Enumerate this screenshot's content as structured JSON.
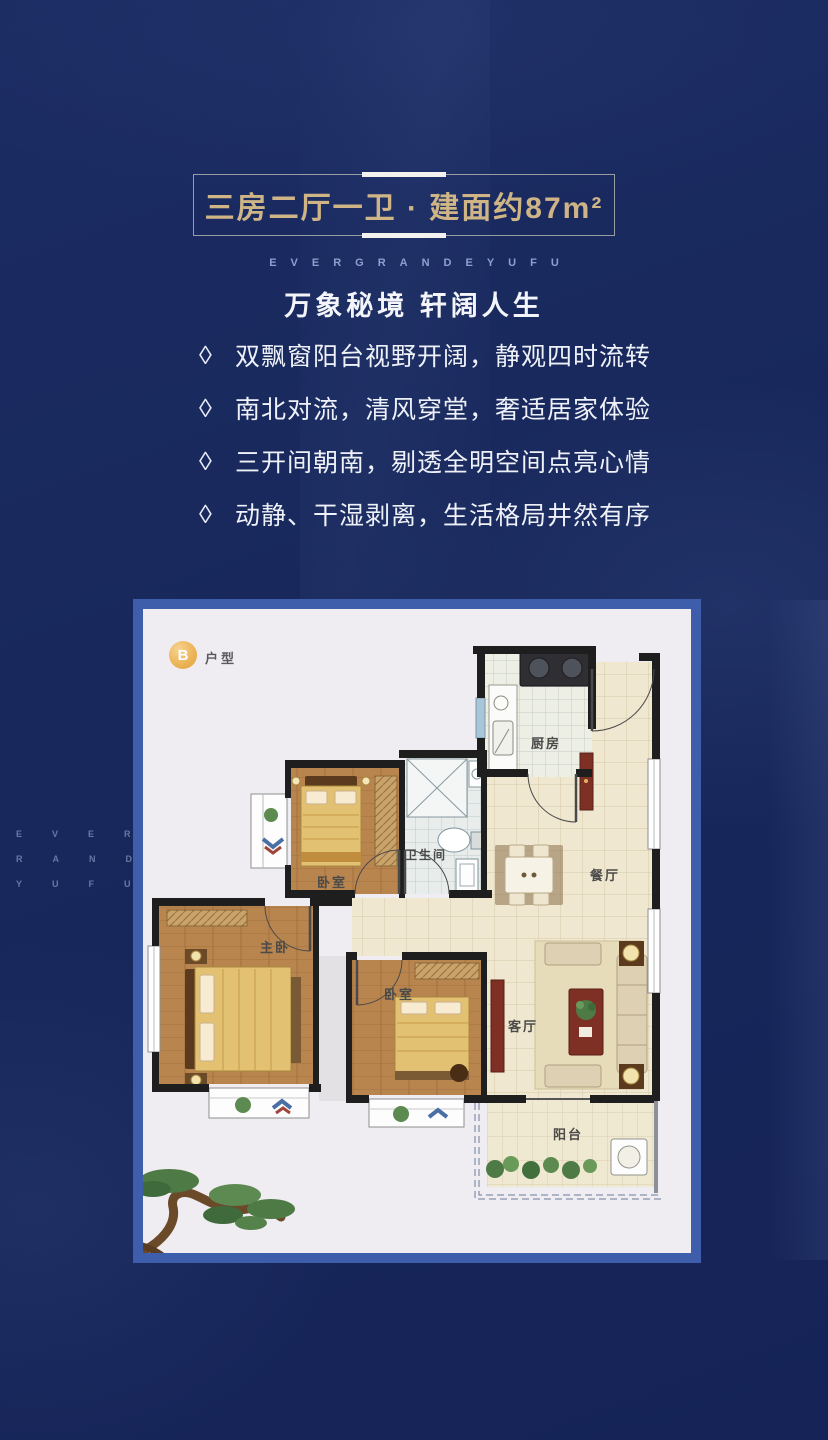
{
  "header": {
    "title": "三房二厅一卫 · 建面约87m²",
    "brand": "EVERGRANDEYUFU",
    "subtitle": "万象秘境 轩阔人生"
  },
  "features": {
    "marker": "◊",
    "items": [
      {
        "text": "双飘窗阳台视野开阔，静观四时流转"
      },
      {
        "text": "南北对流，清风穿堂，奢适居家体验"
      },
      {
        "text": "三开间朝南，剔透全明空间点亮心情"
      },
      {
        "text": "动静、干湿剥离，生活格局井然有序"
      }
    ]
  },
  "floorplan": {
    "badge": "B",
    "badge_label": "户型",
    "rooms": {
      "kitchen": "厨房",
      "bathroom": "卫生间",
      "dining": "餐厅",
      "bedroom_top": "卧室",
      "bedroom_mid": "卧室",
      "master": "主卧",
      "living": "客厅",
      "balcony": "阳台"
    }
  },
  "watermark": {
    "line1": "EVERG",
    "line2": "RANDE",
    "line3": "YUFU"
  },
  "colors": {
    "background_navy": "#19295e",
    "card_border_blue": "#3e5dab",
    "title_gold": "#cfb586",
    "badge_gold": "#e9ad4c"
  }
}
